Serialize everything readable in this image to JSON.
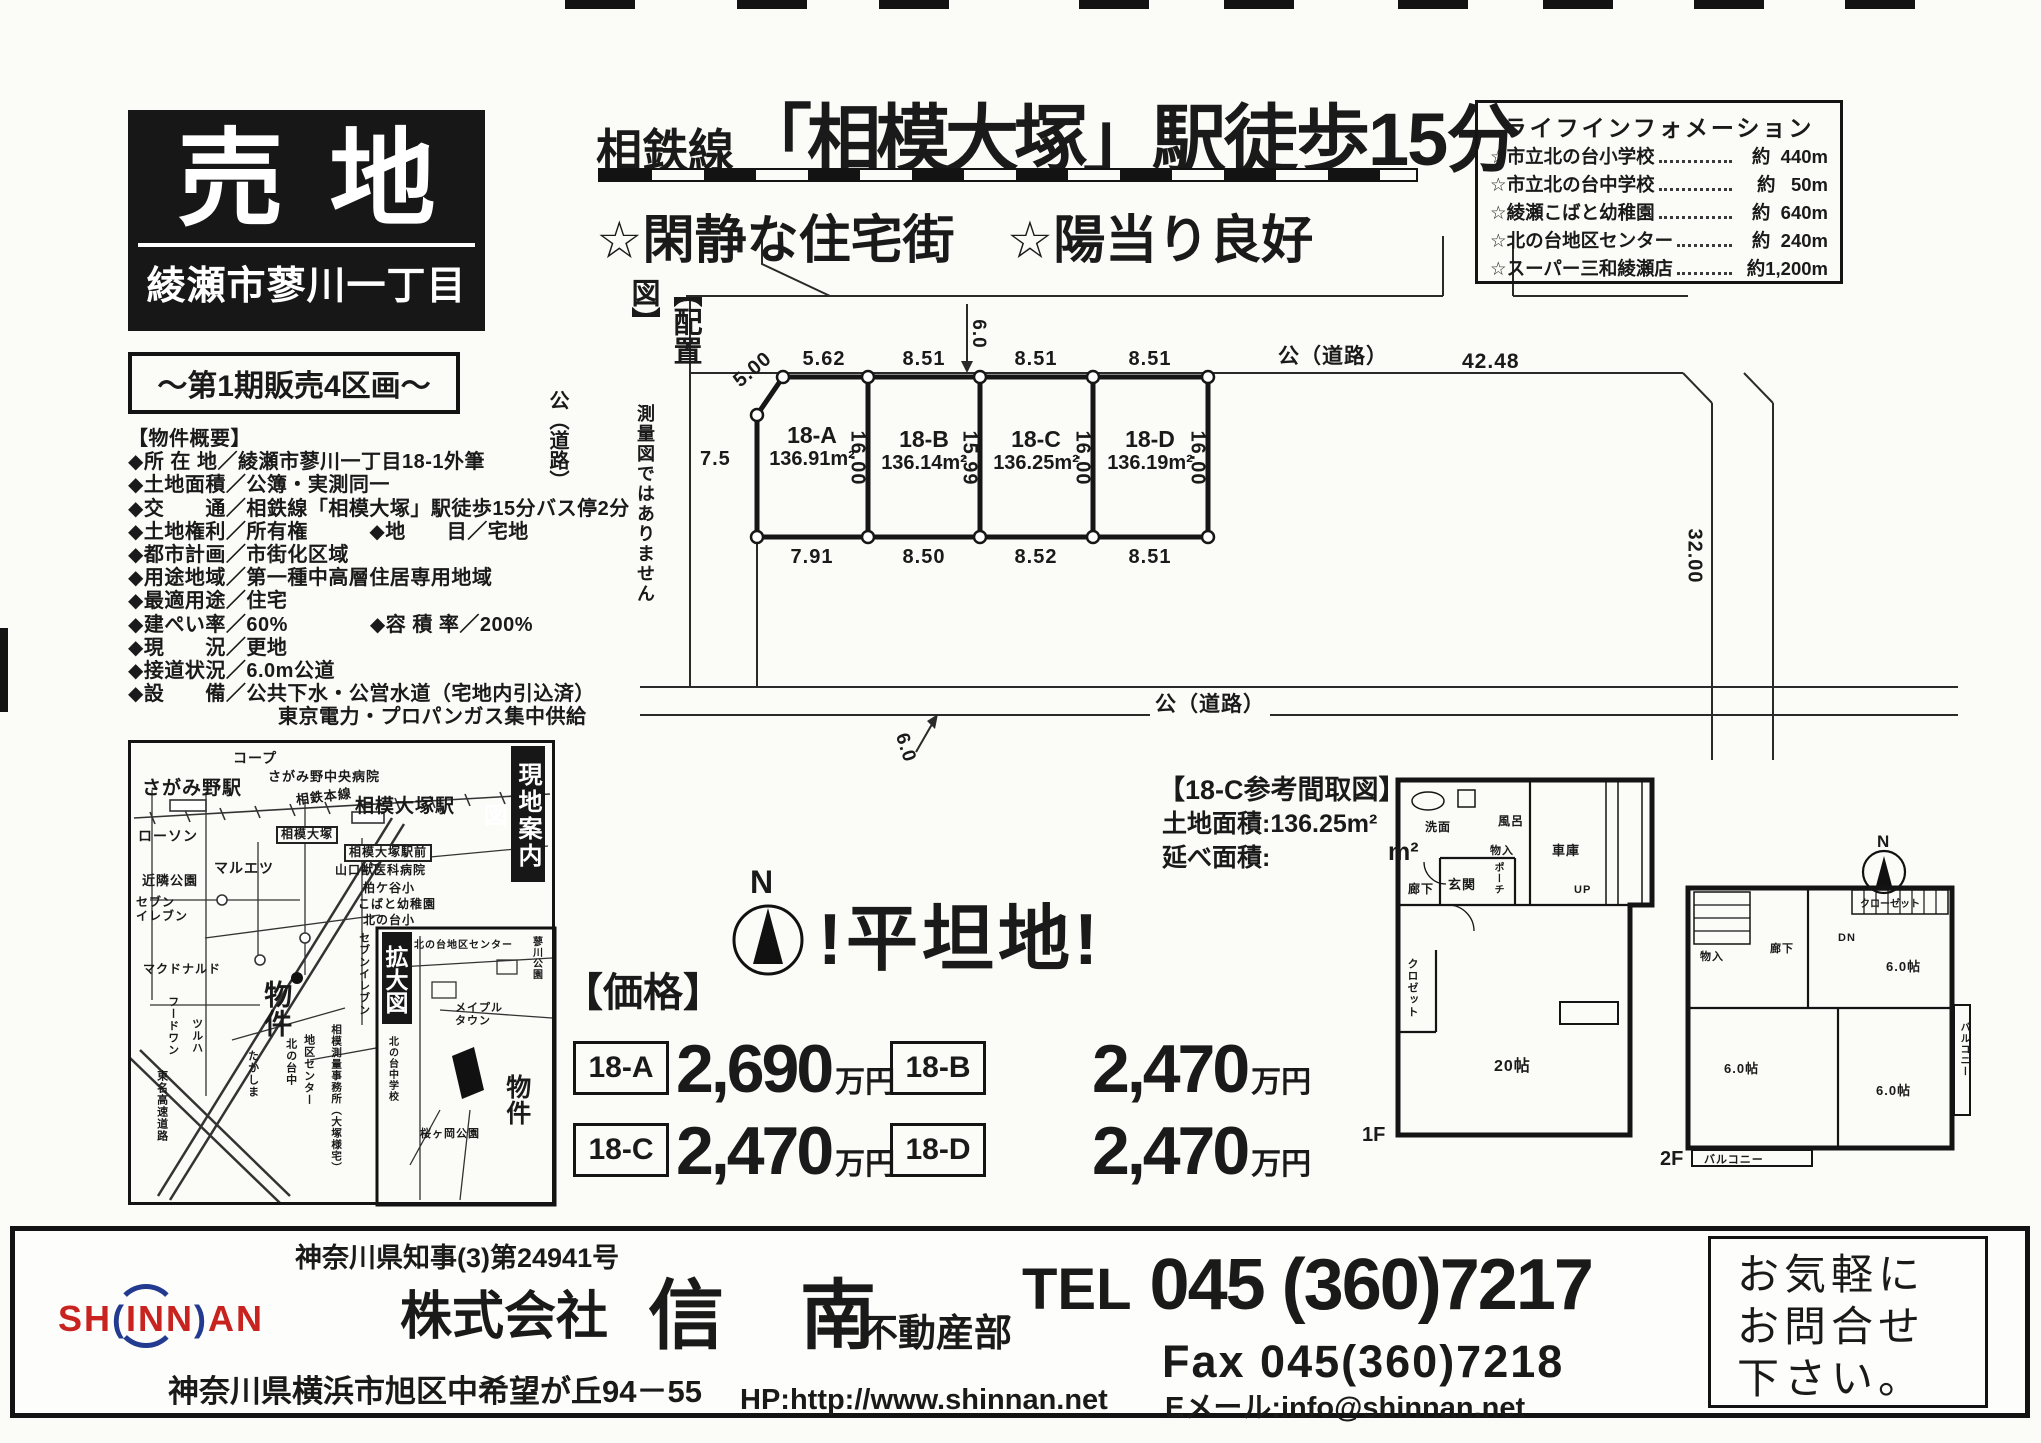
{
  "badges": {
    "sale": "売地",
    "location": "綾瀬市蓼川一丁目",
    "phase": "～第1期販売4区画～"
  },
  "headline": {
    "prefix": "相鉄線",
    "station": "「相模大塚」",
    "walk": "駅徒歩15分",
    "sub": "☆閑静な住宅街　☆陽当り良好"
  },
  "life_info": {
    "title": "ライフインフォメーション",
    "items": [
      {
        "label": "☆市立北の台小学校",
        "value": "約  440m"
      },
      {
        "label": "☆市立北の台中学校",
        "value": "約   50m"
      },
      {
        "label": "☆綾瀬こばと幼稚園",
        "value": "約  640m"
      },
      {
        "label": "☆北の台地区センター",
        "value": "約  240m"
      },
      {
        "label": "☆スーパー三和綾瀬店",
        "value": "約1,200m"
      }
    ]
  },
  "overview": {
    "title": "【物件概要】",
    "lines": [
      "◆所 在 地／綾瀬市蓼川一丁目18-1外筆",
      "◆土地面積／公簿・実測同一",
      "◆交　　通／相鉄線「相模大塚」駅徒歩15分バス停2分",
      "◆土地権利／所有権　　　◆地　　目／宅地",
      "◆都市計画／市街化区域",
      "◆用途地域／第一種中高層住居専用地域",
      "◆最適用途／住宅",
      "◆建ぺい率／60%　　　　◆容 積 率／200%",
      "◆現　　況／更地",
      "◆接道状況／6.0m公道",
      "◆設　　備／公共下水・公営水道（宅地内引込済）",
      "東京電力・プロパンガス集中供給"
    ]
  },
  "site_plan": {
    "label": "【配置図】",
    "note": "測量図ではありません",
    "flat": "!平坦地!",
    "compass": "N",
    "lots": [
      {
        "id": "18-A",
        "area": "136.91m²",
        "top": "5.62",
        "bottom": "7.91",
        "side": "16.00"
      },
      {
        "id": "18-B",
        "area": "136.14m²",
        "top": "8.51",
        "bottom": "8.50",
        "side": "15.99"
      },
      {
        "id": "18-C",
        "area": "136.25m²",
        "top": "8.51",
        "bottom": "8.52",
        "side": "16.00"
      },
      {
        "id": "18-D",
        "area": "136.19m²",
        "top": "8.51",
        "bottom": "8.51",
        "side": "16.00"
      }
    ],
    "dims": {
      "diag": "5.00",
      "left_width": "7.5",
      "top_len": "42.48",
      "right_len": "32.00",
      "road_top": "6.0",
      "road_bottom": "6.0"
    },
    "roads": {
      "top": "公（道路）",
      "bottom": "公（道路）",
      "left": "公（道路）"
    }
  },
  "prices": {
    "title": "【価格】",
    "unit": "万円",
    "entries": [
      {
        "code": "18-A",
        "price": "2,690"
      },
      {
        "code": "18-B",
        "price": "2,470"
      },
      {
        "code": "18-C",
        "price": "2,470"
      },
      {
        "code": "18-D",
        "price": "2,470"
      }
    ]
  },
  "floor_plan": {
    "title": "【18-C参考間取図】",
    "land_area": "土地面積:136.25m²",
    "total_label": "延べ面積:",
    "total_unit": "m²",
    "f1": "1F",
    "f2": "2F",
    "compass": "N",
    "rooms_1f": [
      "洗面",
      "風呂",
      "物入",
      "車庫",
      "玄関",
      "ポーチ",
      "廊下",
      "UP",
      "クロゼット",
      "20帖"
    ],
    "rooms_2f": [
      "物入",
      "クローゼット",
      "DN",
      "6.0帖",
      "廊下",
      "6.0帖",
      "バルコニー",
      "6.0帖",
      "バルコニー"
    ]
  },
  "map": {
    "label": "現地案内図",
    "zoom_label": "拡大図",
    "labels": [
      "さがみ野駅",
      "コープ",
      "さがみ野中央病院",
      "相鉄本線",
      "相模大塚駅",
      "ローソン",
      "マルエツ",
      "相模大塚",
      "相模大塚駅前",
      "近隣公園",
      "セブン\nイレブン",
      "山口獣医科病院",
      "柏ケ谷小",
      "こばと幼稚園",
      "北の台小",
      "セブンイレブン",
      "マクドナルド",
      "フードワン",
      "ツルハ",
      "たかしま",
      "東名高速道路",
      "物件",
      "北の台中",
      "地区センター",
      "相模測量事務所（大塚様宅）",
      "北の台地区センター",
      "蓼川公園",
      "メイプル\nタウン",
      "北の台中学校",
      "物件",
      "桜ヶ岡公園"
    ]
  },
  "footer": {
    "license": "神奈川県知事(3)第24941号",
    "logo_pre": "SH",
    "logo_mid": "INN",
    "logo_post": "AN",
    "company_prefix": "株式会社",
    "company_name": "信　南",
    "department": "不動産部",
    "address": "神奈川県横浜市旭区中希望が丘94－55",
    "tel_label": "TEL",
    "tel_number": "045 (360)7217",
    "fax": "Fax 045(360)7218",
    "hp": "HP:http://www.shinnan.net",
    "email": "Eメール:info@shinnan.net",
    "contact": [
      "お気軽に",
      "お問合せ",
      "下さい。"
    ]
  }
}
